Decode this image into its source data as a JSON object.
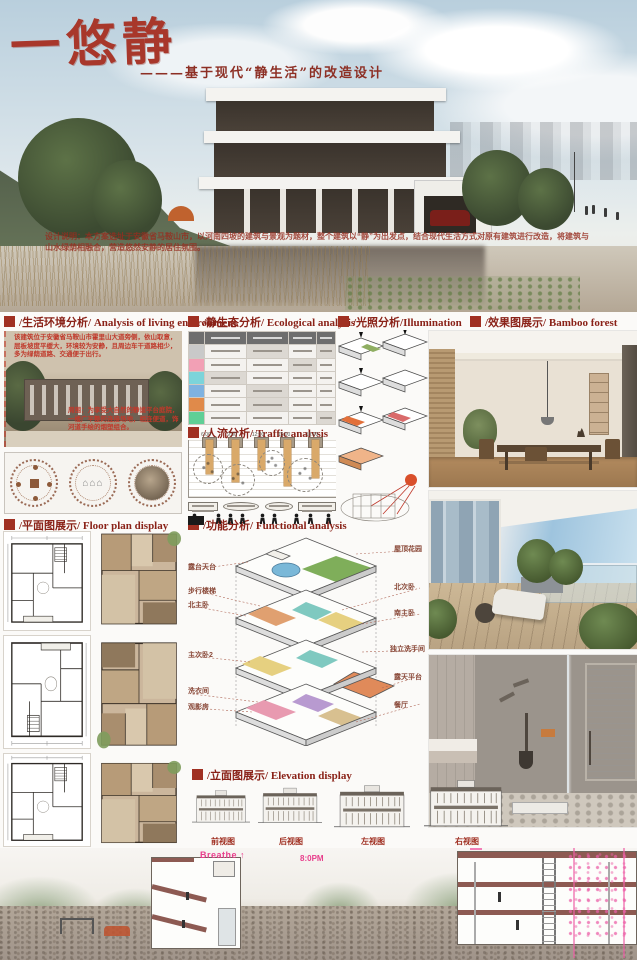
{
  "poster": {
    "title": "一悠静",
    "subtitle": "———基于现代“静生活”的改造设计",
    "design_note_label": "设计说明：",
    "design_note": "本方案选址于安徽省马鞍山市，以河南四坡的建筑与景观为题材，整个建筑以“静”为出发点，结合现代生活方式对原有建筑进行改造，将建筑与山水绿荫相融合，营造悠然安静的居住氛围。"
  },
  "sections": {
    "living_env": {
      "title": "/生活环境分析/ Analysis of living environment",
      "photo_note": "该建筑位于安徽省马鞍山市霍里山大道旁侧，依山取意，层板坡度平缓大，环境较为安静，且周边车干道路相少，多为绿荫道路、交通便于出行。",
      "photo_caption": "周围：为享受大自然的静谧平台庭院，一楼广平整的连接场地，相连便道，饰河道手绘的烟塑组合。"
    },
    "ecological": {
      "title": "/静生态分析/ Ecological analysis",
      "row_colors": [
        "#c9c9c9",
        "#f2a0b5",
        "#7cd4da",
        "#7fb2e0",
        "#e6d2b8",
        "#e08a4a",
        "#5fcf96"
      ]
    },
    "illumination": {
      "title": "/光照分析/Illumination"
    },
    "effect": {
      "title": "/效果图展示/ Bamboo forest"
    },
    "traffic": {
      "title": "/人流分析/ Traffic analysis",
      "time_labels": [
        "6:00",
        "9:00",
        "12:00",
        "15:00",
        "18:00"
      ]
    },
    "functional": {
      "title": "/功能分析/ Functional analysis",
      "left_labels": [
        "露台天台",
        "步行楼梯",
        "北主卧",
        "主次卧2",
        "洗衣间",
        "观影房"
      ],
      "right_labels": [
        "屋顶花园",
        "北次卧",
        "南主卧",
        "独立洗手间",
        "露天平台",
        "餐厅"
      ]
    },
    "floor_plan": {
      "title": "/平面图展示/ Floor plan display"
    },
    "elevation": {
      "title": "/立面图展示/ Elevation display",
      "labels": [
        "前视图",
        "后视图",
        "左视图",
        "右视图"
      ]
    }
  },
  "bottom": {
    "breathe_label": "Breathe",
    "arrow": "↑",
    "time_label": "8:0PM"
  },
  "colors": {
    "accent_red": "#a8372b",
    "header_red": "#8a2218",
    "annotation_red": "#c03a2b",
    "pink": "#ef5fa7",
    "bar_tan": "#d9a96a",
    "maroon_section": "#8d5a52"
  }
}
